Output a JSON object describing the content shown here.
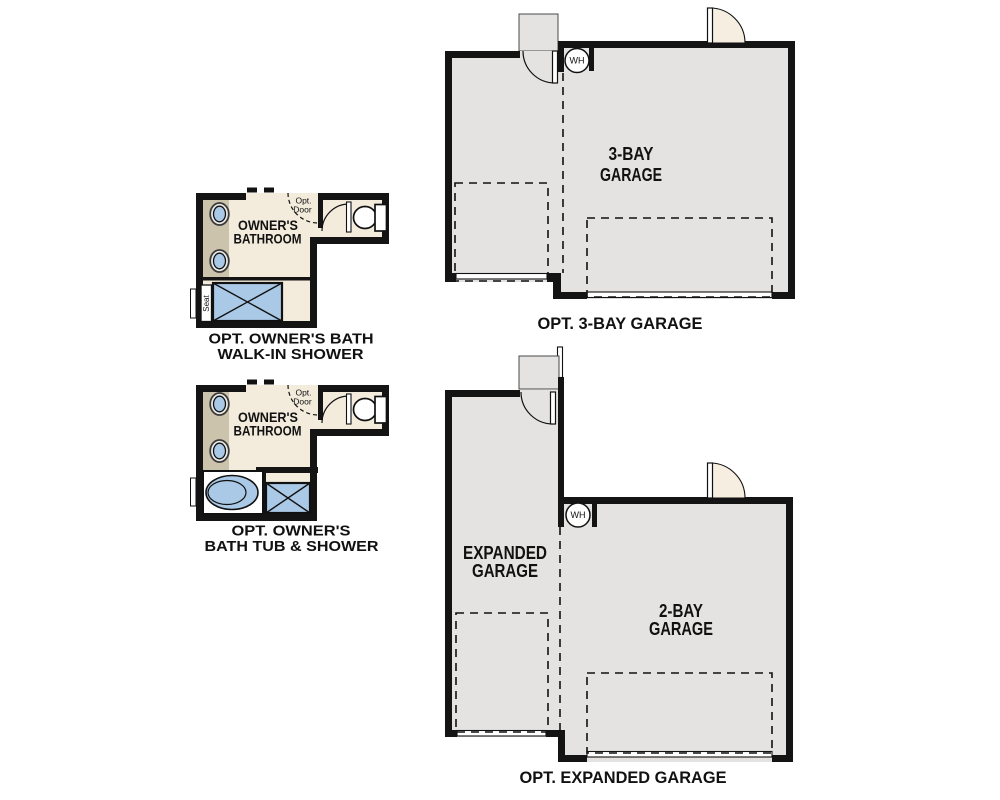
{
  "colors": {
    "ink": "#111111",
    "wall": "#141414",
    "bath_floor": "#f3ecdc",
    "counter": "#ccc3ad",
    "fixture_blue": "#a9c9e6",
    "garage_floor": "#e4e3e1",
    "door_swing": "#f6eee1",
    "page_bg": "#ffffff"
  },
  "plans": {
    "bath_walkin": {
      "room_label_1": "OWNER'S",
      "room_label_2": "BATHROOM",
      "opt_door_1": "Opt.",
      "opt_door_2": "Door",
      "seat_label": "Seat",
      "caption_1": "OPT. OWNER'S BATH",
      "caption_2": "WALK-IN SHOWER"
    },
    "bath_tub": {
      "room_label_1": "OWNER'S",
      "room_label_2": "BATHROOM",
      "opt_door_1": "Opt.",
      "opt_door_2": "Door",
      "caption_1": "OPT. OWNER'S",
      "caption_2": "BATH TUB & SHOWER"
    },
    "garage_3bay": {
      "room_label_1": "3-BAY",
      "room_label_2": "GARAGE",
      "wh_label": "WH",
      "caption": "OPT. 3-BAY GARAGE"
    },
    "garage_expanded": {
      "left_label_1": "EXPANDED",
      "left_label_2": "GARAGE",
      "right_label_1": "2-BAY",
      "right_label_2": "GARAGE",
      "wh_label": "WH",
      "caption": "OPT. EXPANDED GARAGE"
    }
  }
}
